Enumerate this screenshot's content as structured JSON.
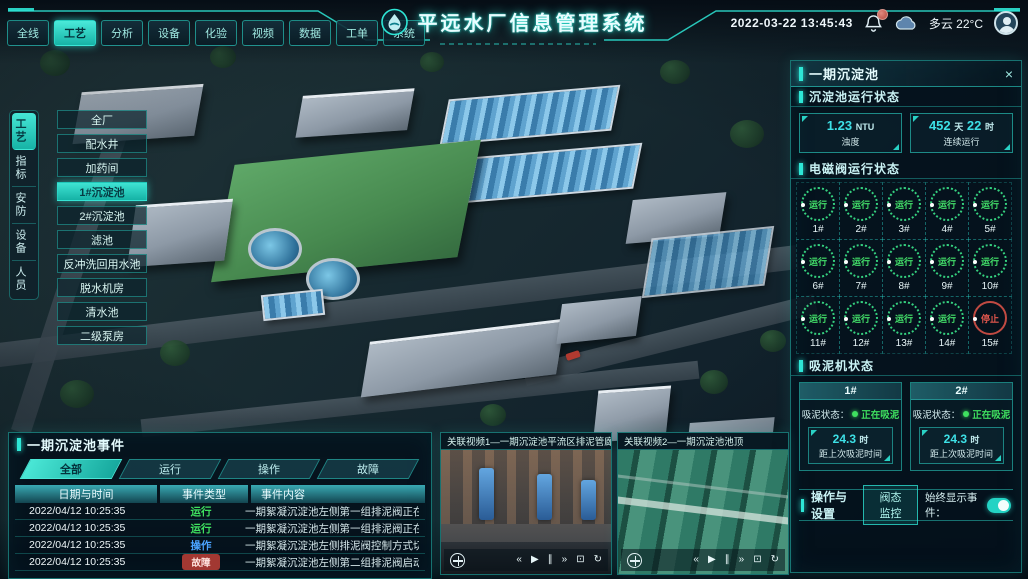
{
  "header": {
    "title": "平远水厂信息管理系统",
    "nav_tabs": [
      "全线",
      "工艺",
      "分析",
      "设备",
      "化验",
      "视频",
      "数据",
      "工单",
      "系统"
    ],
    "nav_active": "工艺",
    "datetime": "2022-03-22 13:45:43",
    "weather": "多云 22°C"
  },
  "side_tabs": {
    "items": [
      "工艺",
      "指标",
      "安防",
      "设备",
      "人员"
    ],
    "active": "工艺"
  },
  "process_menu": {
    "items": [
      "全厂",
      "配水井",
      "加药间",
      "1#沉淀池",
      "2#沉淀池",
      "滤池",
      "反冲洗回用水池",
      "脱水机房",
      "清水池",
      "二级泵房"
    ],
    "active": "1#沉淀池"
  },
  "right_panel": {
    "title": "一期沉淀池",
    "run_status": {
      "title": "沉淀池运行状态",
      "turbidity": {
        "value": "1.23",
        "unit": "NTU",
        "label": "浊度"
      },
      "uptime": {
        "value1": "452",
        "unit1": "天",
        "value2": "22",
        "unit2": "时",
        "label": "连续运行"
      }
    },
    "valves": {
      "title": "电磁阀运行状态",
      "running_label": "运行",
      "stopped_label": "停止",
      "items": [
        {
          "id": "1#",
          "status": "run"
        },
        {
          "id": "2#",
          "status": "run"
        },
        {
          "id": "3#",
          "status": "run"
        },
        {
          "id": "4#",
          "status": "run"
        },
        {
          "id": "5#",
          "status": "run"
        },
        {
          "id": "6#",
          "status": "run"
        },
        {
          "id": "7#",
          "status": "run"
        },
        {
          "id": "8#",
          "status": "run"
        },
        {
          "id": "9#",
          "status": "run"
        },
        {
          "id": "10#",
          "status": "run"
        },
        {
          "id": "11#",
          "status": "run"
        },
        {
          "id": "12#",
          "status": "run"
        },
        {
          "id": "13#",
          "status": "run"
        },
        {
          "id": "14#",
          "status": "run"
        },
        {
          "id": "15#",
          "status": "stop"
        }
      ]
    },
    "mud": {
      "title": "吸泥机状态",
      "machines": [
        {
          "id": "1#",
          "status_label": "吸泥状态：",
          "status": "正在吸泥",
          "value": "24.3",
          "unit": "时",
          "caption": "距上次吸泥时间"
        },
        {
          "id": "2#",
          "status_label": "吸泥状态：",
          "status": "正在吸泥",
          "value": "24.3",
          "unit": "时",
          "caption": "距上次吸泥时间"
        }
      ]
    },
    "ops": {
      "title": "操作与设置",
      "button": "阀态监控",
      "toggle_label": "始终显示事件：",
      "toggle_state": "on"
    }
  },
  "events": {
    "title": "一期沉淀池事件",
    "tabs": [
      "全部",
      "运行",
      "操作",
      "故障"
    ],
    "active_tab": "全部",
    "columns": [
      "日期与时间",
      "事件类型",
      "事件内容"
    ],
    "rows": [
      {
        "time": "2022/04/12 10:25:35",
        "type_key": "run",
        "type": "运行",
        "content": "一期絮凝沉淀池左侧第一组排泥阀正在排泥"
      },
      {
        "time": "2022/04/12 10:25:35",
        "type_key": "run",
        "type": "运行",
        "content": "一期絮凝沉淀池左侧第一组排泥阀正在排泥"
      },
      {
        "time": "2022/04/12 10:25:35",
        "type_key": "op",
        "type": "操作",
        "content": "一期絮凝沉淀池左侧排泥阀控制方式切换为手动"
      },
      {
        "time": "2022/04/12 10:25:35",
        "type_key": "fault",
        "type": "故障",
        "content": "一期絮凝沉淀池左侧第二组排泥阀启动失败"
      }
    ]
  },
  "videos": [
    {
      "title": "关联视频1—一期沉淀池平流区排泥管廊"
    },
    {
      "title": "关联视频2—一期沉淀池池顶"
    }
  ],
  "icons": {
    "close": "×",
    "skip_back": "«",
    "play": "▶",
    "pause": "∥",
    "skip_forward": "»",
    "fullscreen": "⊡",
    "loop": "↻"
  },
  "colors": {
    "accent": "#2ee6d6",
    "running": "#3fe05f",
    "operate": "#4aa3ff",
    "fault": "#b5473c"
  }
}
